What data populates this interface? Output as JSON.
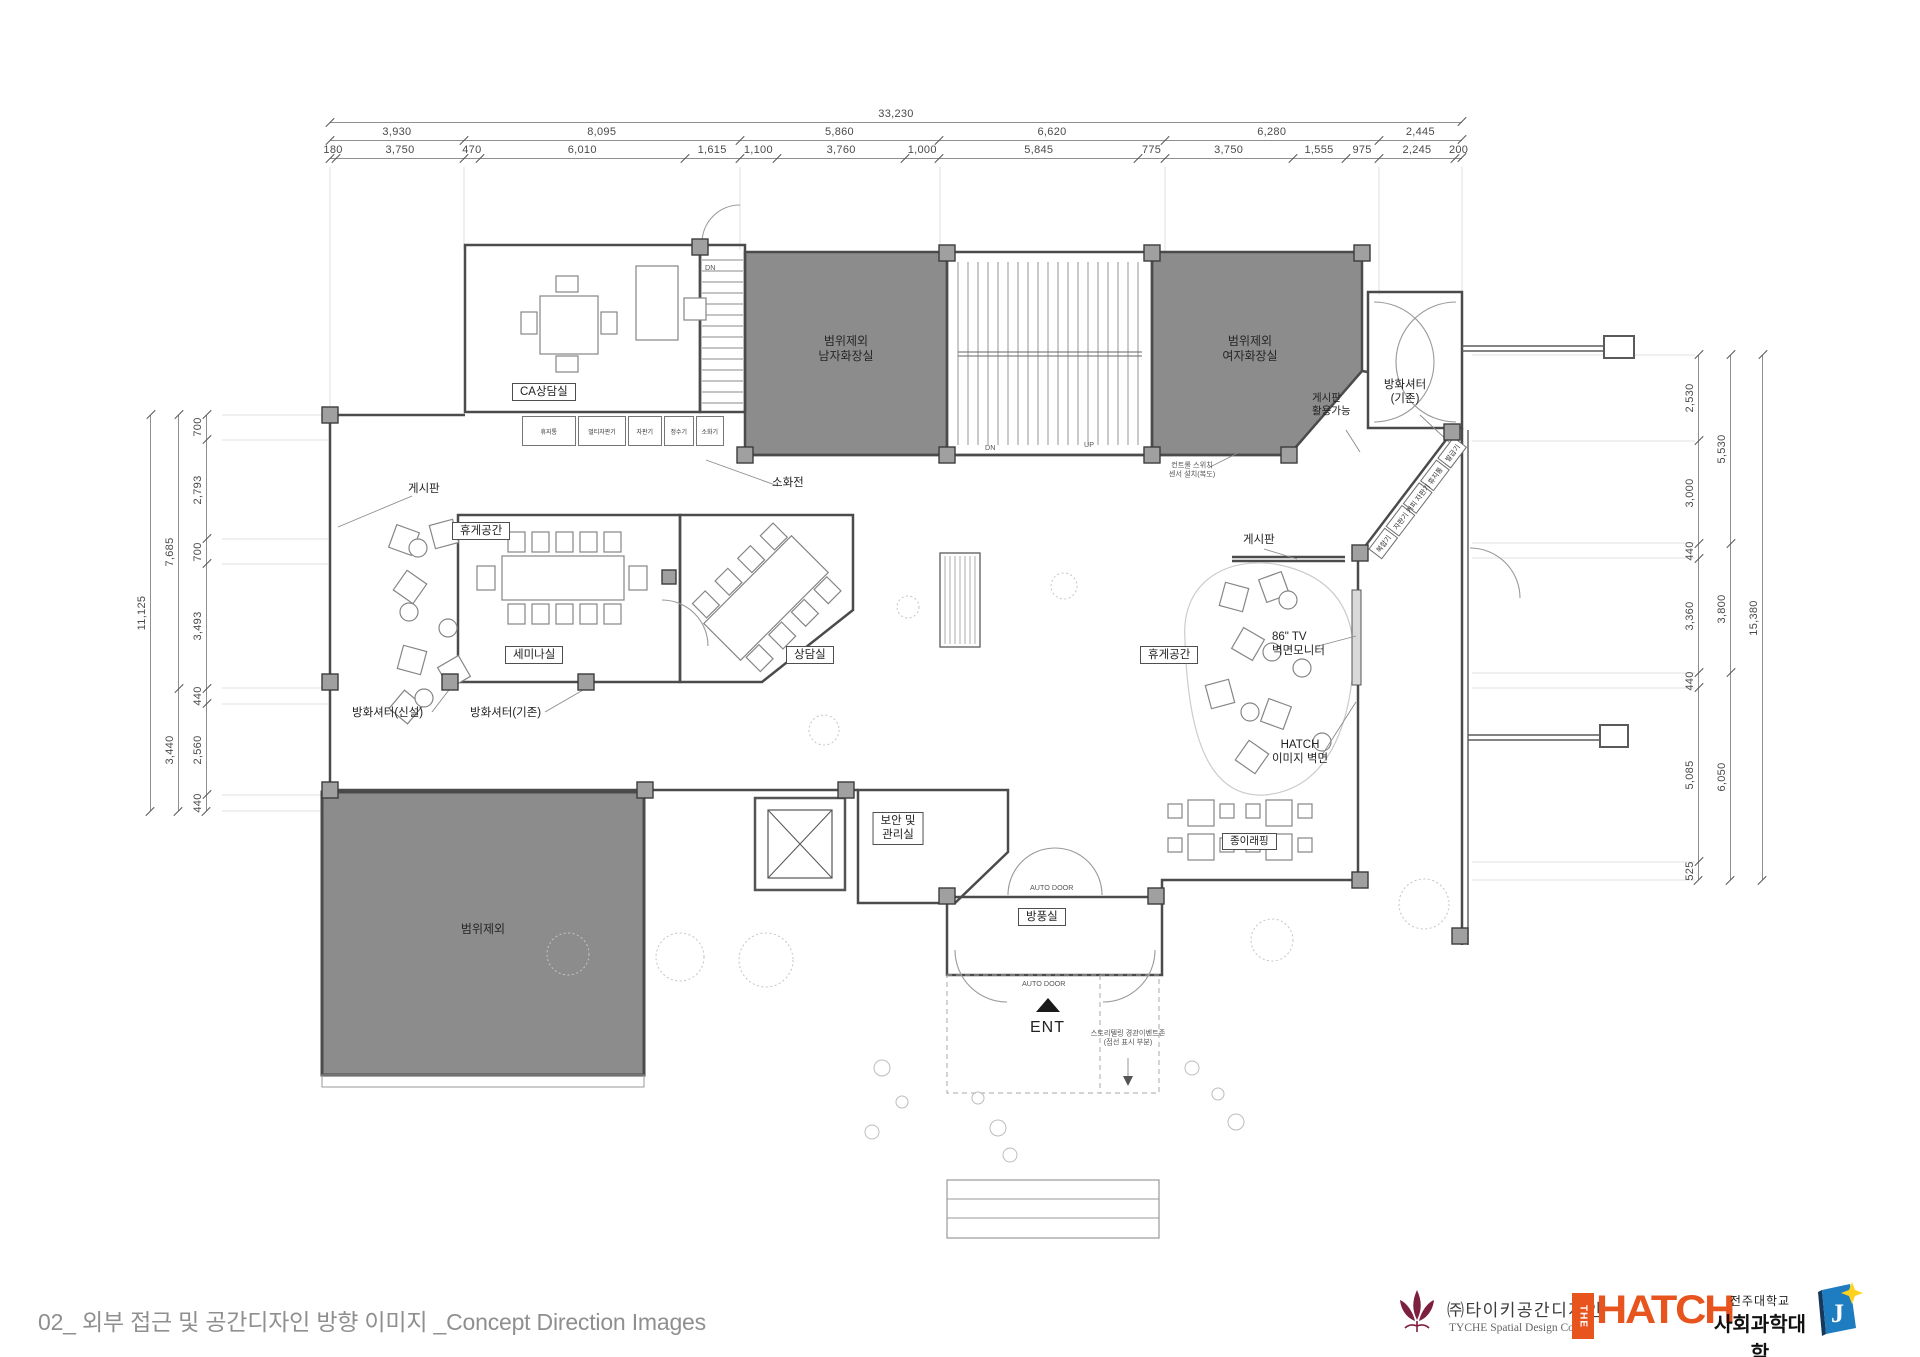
{
  "dimensions": {
    "top": {
      "total": [
        {
          "label": "33,230",
          "v": 33230
        }
      ],
      "row1": [
        {
          "label": "3,930",
          "v": 3930
        },
        {
          "label": "8,095",
          "v": 8095
        },
        {
          "label": "5,860",
          "v": 5860
        },
        {
          "label": "6,620",
          "v": 6620
        },
        {
          "label": "6,280",
          "v": 6280
        },
        {
          "label": "2,445",
          "v": 2445
        }
      ],
      "row2": [
        {
          "label": "180",
          "v": 180
        },
        {
          "label": "3,750",
          "v": 3750
        },
        {
          "label": "470",
          "v": 470
        },
        {
          "label": "6,010",
          "v": 6010
        },
        {
          "label": "1,615",
          "v": 1615
        },
        {
          "label": "1,100",
          "v": 1100
        },
        {
          "label": "3,760",
          "v": 3760
        },
        {
          "label": "1,000",
          "v": 1000
        },
        {
          "label": "5,845",
          "v": 5845
        },
        {
          "label": "775",
          "v": 775
        },
        {
          "label": "3,750",
          "v": 3750
        },
        {
          "label": "1,555",
          "v": 1555
        },
        {
          "label": "975",
          "v": 975
        },
        {
          "label": "2,245",
          "v": 2245
        },
        {
          "label": "200",
          "v": 200
        }
      ]
    },
    "left": {
      "outer": [
        {
          "label": "11,125",
          "v": 11125
        }
      ],
      "middle": [
        {
          "label": "7,685",
          "v": 7685
        },
        {
          "label": "3,440",
          "v": 3440
        }
      ],
      "inner": [
        {
          "label": "700",
          "v": 700
        },
        {
          "label": "2,793",
          "v": 2793
        },
        {
          "label": "700",
          "v": 700
        },
        {
          "label": "3,493",
          "v": 3493
        },
        {
          "label": "440",
          "v": 440
        },
        {
          "label": "2,560",
          "v": 2560
        },
        {
          "label": "440",
          "v": 440
        }
      ]
    },
    "right": {
      "outer": [
        {
          "label": "15,380",
          "v": 15380
        }
      ],
      "middle": [
        {
          "label": "5,530",
          "v": 5530
        },
        {
          "label": "3,800",
          "v": 3800
        },
        {
          "label": "6,050",
          "v": 6050
        }
      ],
      "inner": [
        {
          "label": "2,530",
          "v": 2530
        },
        {
          "label": "3,000",
          "v": 3000
        },
        {
          "label": "440",
          "v": 440
        },
        {
          "label": "3,360",
          "v": 3360
        },
        {
          "label": "440",
          "v": 440
        },
        {
          "label": "5,085",
          "v": 5085
        },
        {
          "label": "525",
          "v": 525
        }
      ]
    }
  },
  "plan": {
    "rooms": {
      "ca_room": "CA상담실",
      "seminar": "세미나실",
      "counsel": "상담실",
      "windbreak": "방풍실",
      "security": "보안 및\n관리실",
      "cafe": "종이래핑",
      "excluded_men": "범위제외\n남자화장실",
      "excluded_women": "범위제외\n여자화장실",
      "excluded_big": "범위제외",
      "rest_left": "휴게공간",
      "rest_right": "휴게공간"
    },
    "labels": {
      "bulletin_left": "게시판",
      "bulletin_right": "게시판",
      "bulletin_topright": "게시판\n활용가능",
      "fire_shutter_new": "방화셔터(신설)",
      "fire_shutter_old": "방화셔터(기존)",
      "fire_shutter_tr": "방화셔터\n(기존)",
      "hydrant": "소화전",
      "tv_wall": "86\" TV\n벽면모니터",
      "hatch_wall": "HATCH\n이미지 벽면",
      "control_switch": "컨트롤 스위치\n센서 설치(복도)",
      "entry": "ENT",
      "auto_door": "AUTO DOOR",
      "dn": "DN",
      "up": "UP",
      "entry_note": "스토리텔링 경관이벤트존\n(점선 표시 부분)"
    },
    "appliances": [
      "휴지통",
      "멀티자판기",
      "자판기",
      "정수기",
      "소화기"
    ],
    "kiosks": [
      "복합기",
      "자판기",
      "커피 자판기",
      "휴지통",
      "발급기"
    ]
  },
  "footer": {
    "title": "02_ 외부 접근 및 공간디자인 방향 이미지 _Concept Direction Images",
    "tyche_kr": "㈜타이키공간디자인",
    "tyche_en": "TYCHE Spatial Design Corp.",
    "hatch_the": "THE",
    "hatch_name": "HATCH",
    "univ_small": "전주대학교",
    "univ_large": "사회과학대학"
  },
  "colors": {
    "wall": "#4b4b4b",
    "excluded_fill": "#8c8c8c",
    "hatch_orange": "#e8541e",
    "tyche_maroon": "#7d1f3e",
    "univ_blue": "#1e7cc0",
    "star_yellow": "#ffd21e",
    "title_gray": "#8f8f8f"
  }
}
